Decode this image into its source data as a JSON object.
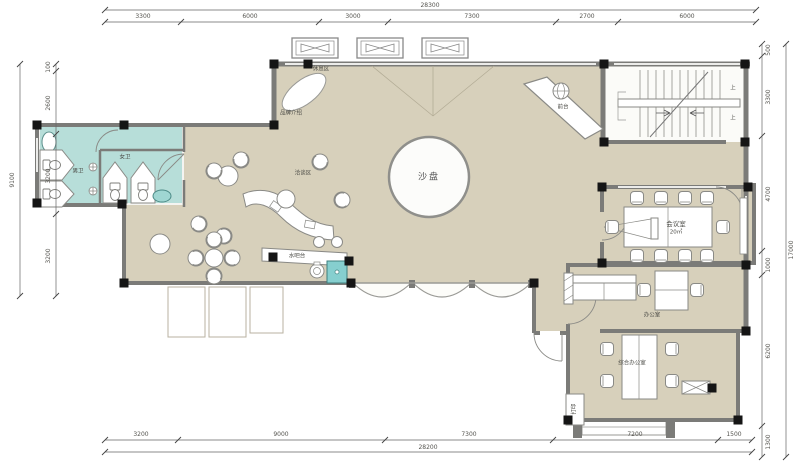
{
  "drawing": {
    "type": "architectural-floor-plan",
    "description": "Sales office / showroom floor plan with dimensions"
  },
  "colors": {
    "floor_beige": "#d7d0bb",
    "wall_gray": "#7b7b78",
    "column_black": "#151515",
    "toilet_cyan": "#b7ded9",
    "appliance_cyan": "#86cfcf",
    "line_gray": "#8a8a86"
  },
  "dims": {
    "top": {
      "total": "28300",
      "segments": [
        "3300",
        "6000",
        "3000",
        "7300",
        "2700",
        "6000"
      ]
    },
    "bottom": {
      "total": "28200",
      "segments": [
        "3200",
        "9000",
        "7300",
        "7200",
        "1500"
      ]
    },
    "left": {
      "total": "9100",
      "segments": [
        "100",
        "2600",
        "3200",
        "3200"
      ]
    },
    "right": {
      "total": "17000",
      "segments": [
        "500",
        "3300",
        "4700",
        "1000",
        "6200",
        "1300"
      ]
    }
  },
  "labels": {
    "sand_table": "沙盘",
    "front_desk": "前台",
    "rest_area": "休息区",
    "brand_intro": "品牌介绍",
    "negotiation_area": "洽谈区",
    "water_bar": "水吧台",
    "mens_toilet": "男卫",
    "womens_toilet": "女卫",
    "meeting_room": "会议室",
    "meeting_room_area": "20㎡",
    "office": "办公室",
    "general_office": "综合办公室",
    "print": "打印",
    "stair_up_1": "上",
    "stair_up_2": "上"
  }
}
